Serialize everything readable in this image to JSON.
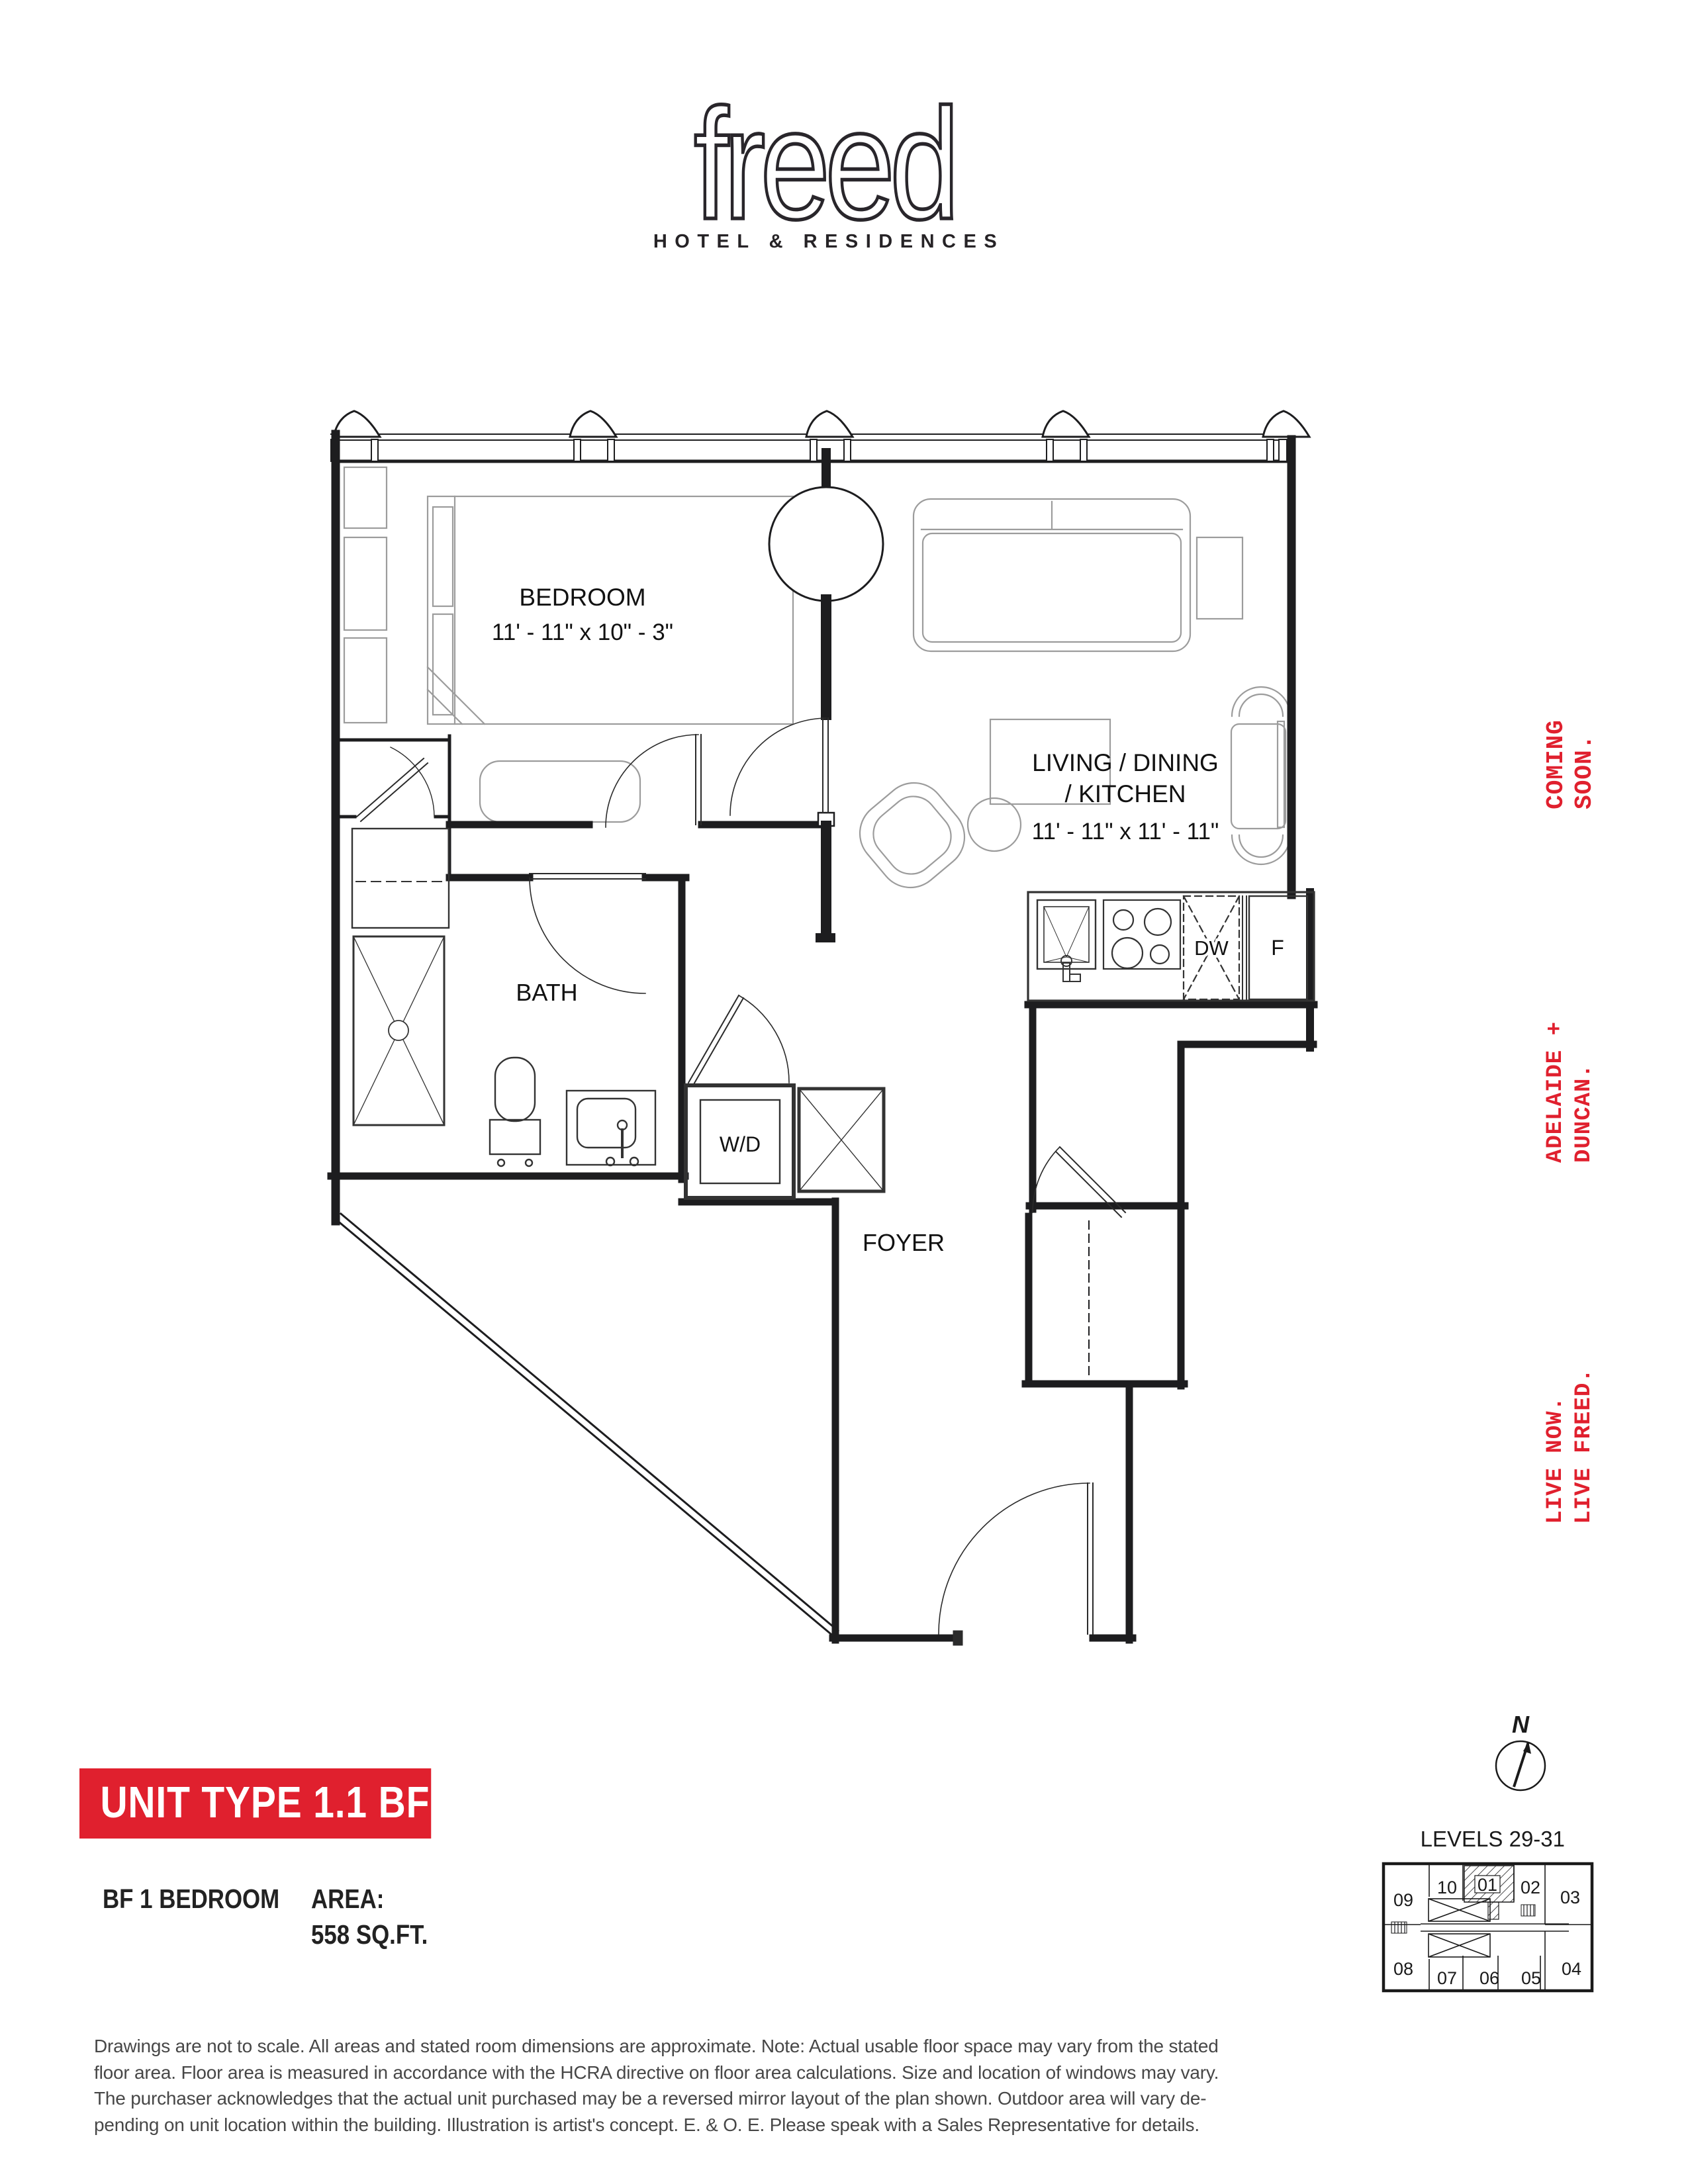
{
  "colors": {
    "red": "#E0202E",
    "ink": "#1D1D1F",
    "furniture_gray": "#9C9C9C"
  },
  "logo": {
    "wordmark": "freed",
    "subtitle": "HOTEL & RESIDENCES"
  },
  "plan": {
    "bedroom_label": "BEDROOM",
    "bedroom_dims": "11' - 11\" x 10\" - 3\"",
    "living_label_1": "LIVING / DINING",
    "living_label_2": "/ KITCHEN",
    "living_dims": "11' - 11\" x 11' - 11\"",
    "bath_label": "BATH",
    "foyer_label": "FOYER",
    "wd_label": "W/D",
    "dw_label": "DW",
    "fridge_label": "F"
  },
  "side_text": {
    "coming": {
      "line1": "COMING",
      "line2": "SOON."
    },
    "adelaide": {
      "line1": "ADELAIDE +",
      "line2": "DUNCAN."
    },
    "live": {
      "line1": "LIVE NOW.",
      "line2": "LIVE FREED."
    }
  },
  "unit_info": {
    "banner": "UNIT TYPE 1.1 BF",
    "type": "BF 1 BEDROOM",
    "area_label": "AREA:",
    "area_value": "558 SQ.FT."
  },
  "keyplan": {
    "levels": "LEVELS 29-31",
    "north": "N",
    "units": {
      "u01": "01",
      "u02": "02",
      "u03": "03",
      "u04": "04",
      "u05": "05",
      "u06": "06",
      "u07": "07",
      "u08": "08",
      "u09": "09",
      "u10": "10"
    }
  },
  "disclaimer": {
    "line1": "Drawings are not to scale. All areas and stated room dimensions are approximate. Note: Actual usable floor space may vary from the stated",
    "line2": "floor area. Floor area is measured in accordance with the HCRA directive on floor area calculations. Size and location of windows may vary.",
    "line3": "The purchaser acknowledges that the actual unit purchased may be a reversed mirror layout of the plan shown. Outdoor area will vary de-",
    "line4": "pending on unit location within the building. Illustration is artist's concept. E. & O. E. Please speak with a Sales Representative for details."
  }
}
